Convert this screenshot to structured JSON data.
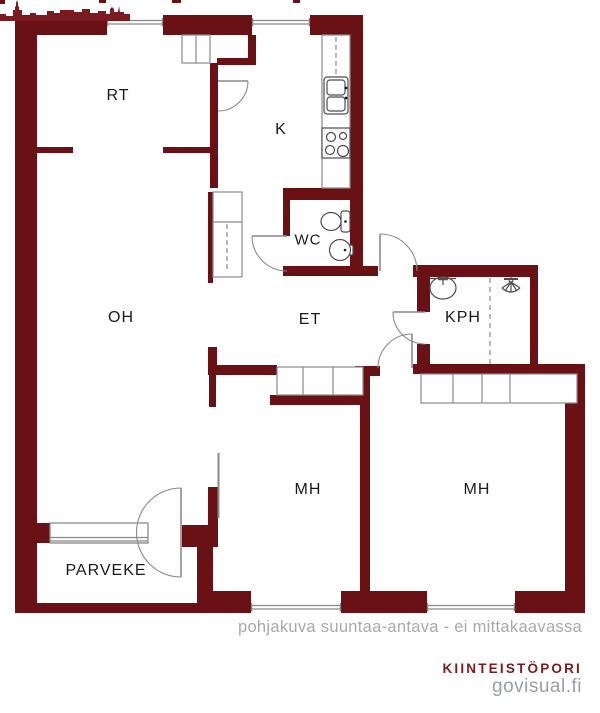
{
  "title": "apartment floor plan",
  "rooms": {
    "rt": "RT",
    "k": "K",
    "wc": "WC",
    "oh": "OH",
    "et": "ET",
    "kph": "KPH",
    "mh1": "MH",
    "mh2": "MH",
    "parveke": "PARVEKE"
  },
  "footer": {
    "caption": "pohjakuva suuntaa-antava - ei mittakaavassa",
    "brand": "KIINTEISTÖPORI",
    "site": "govisual.fi"
  },
  "colors": {
    "wall": "#6A1116",
    "thin_line": "#8a8a8a",
    "fixture_line": "#4d4d4d",
    "label_text": "#1a1a1a",
    "caption_text": "#a9a9a9",
    "brand_text": "#7b1b20",
    "site_text": "#99a0a0",
    "background": "#ffffff"
  },
  "icons": {
    "toilet": "toilet-icon",
    "wc_sink": "sink-icon",
    "kph_sink": "sink-icon",
    "shower": "shower-icon",
    "kitchen_sink": "kitchen-sink-icon",
    "stove": "stove-icon",
    "skyline": "city-skyline-icon"
  }
}
